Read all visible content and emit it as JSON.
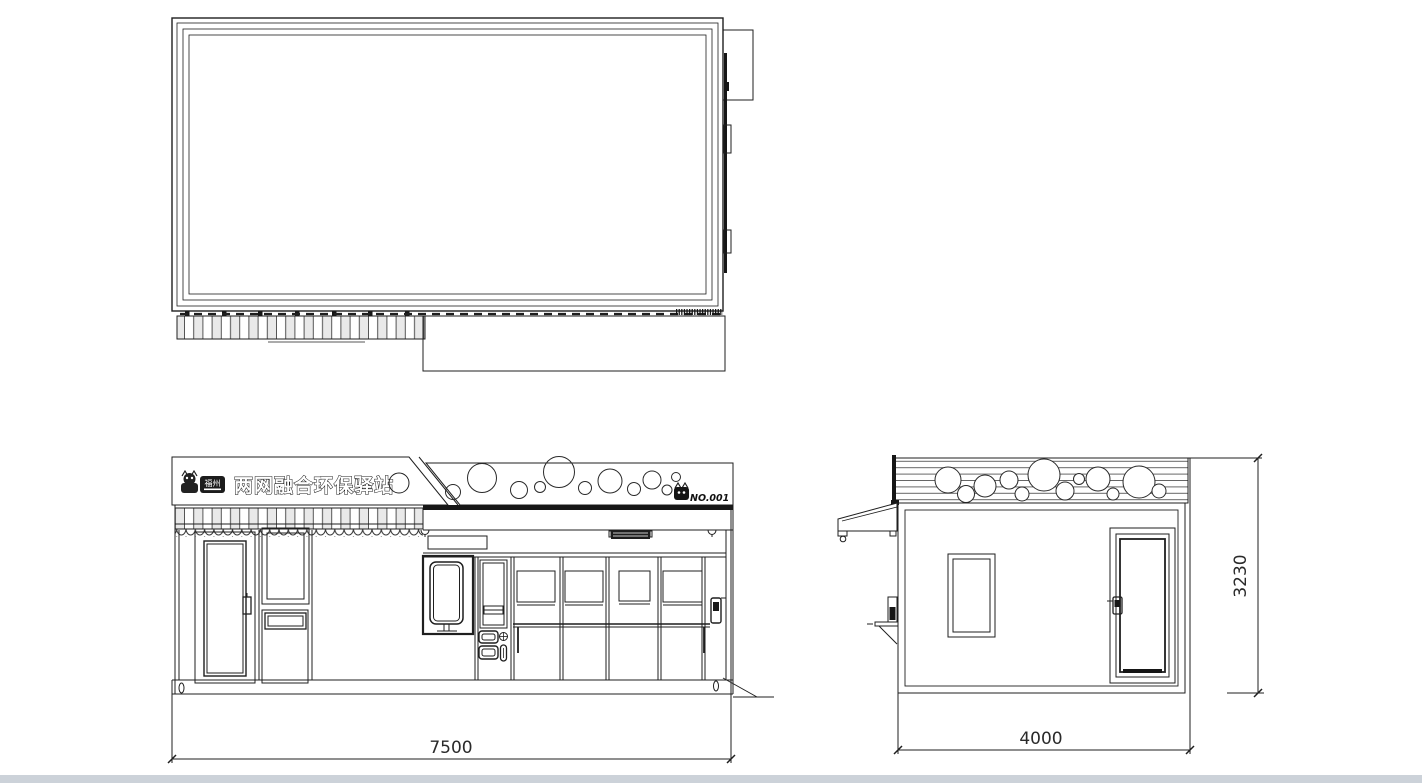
{
  "signage": {
    "title": "两网融合环保驿站",
    "station_number": "NO.001",
    "logo_badge": "福州"
  },
  "dimensions": {
    "front_width_mm": "7500",
    "side_depth_mm": "4000",
    "height_mm": "3230"
  },
  "icons": {
    "logo_mascot": "cat-mascot",
    "station_mascot": "cat-mascot"
  },
  "colors": {
    "line": "#1f1f1f",
    "dark_fill": "#161616",
    "slat_gray": "#e9e9e9",
    "bottom_bar": "#ccd2d9",
    "background": "#ffffff"
  }
}
